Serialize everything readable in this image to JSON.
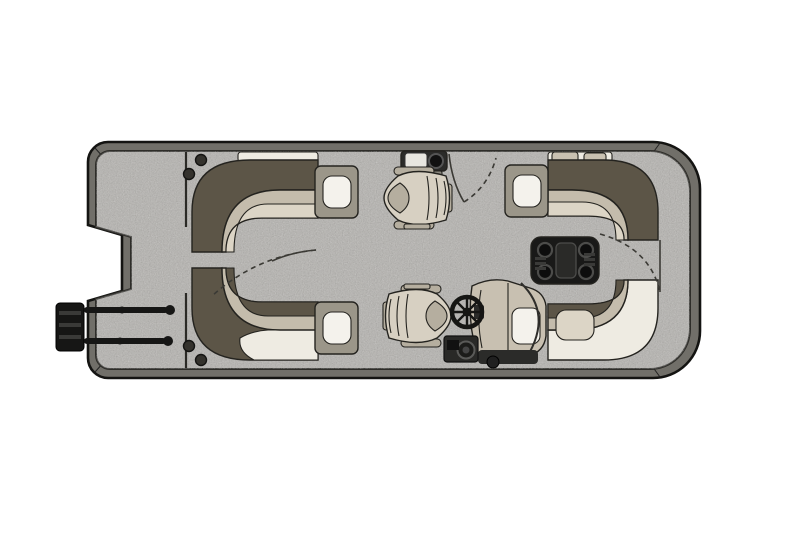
{
  "floorplan": {
    "type": "pontoon-boat-floor-plan",
    "view": "top-down",
    "orientation": "bow-right",
    "components": [
      "stern-swim-deck",
      "motor-cutout-notch",
      "boarding-ladder",
      "port-aft-lounge",
      "starboard-aft-lounge",
      "aft-lounge-armrest-cupholders",
      "stern-gate-swing",
      "port-side-gate-swing",
      "bow-gate-swing",
      "refreshment-console-with-sink",
      "companion-captain-chair",
      "helm-captain-chair",
      "helm-console-with-steering-wheel",
      "cocktail-table-with-cupholders",
      "port-bow-lounge",
      "starboard-bow-lounge",
      "bow-deck",
      "speakers",
      "throw-pillows"
    ]
  },
  "colors": {
    "background": "#ffffff",
    "rim": "#716f69",
    "carpet": "#b4b2ae",
    "panel_line": "#2b2a26",
    "seat_back_dark": "#5c5547",
    "seat_cushion": "#c4bcac",
    "seat_cushion_pale": "#dcd5c6",
    "seat_highlight": "#eeebe2",
    "armrest_panel": "#9b9689",
    "cupholder_white": "#f4f2ec",
    "pillow": "#c9c1b1",
    "table_black": "#191918",
    "table_ring": "#4c4c4a",
    "table_lid": "#2a2a28",
    "chair_body": "#d7d0c2",
    "chair_shade": "#b5ae9f",
    "console_body": "#c8c0b1",
    "console_dark": "#2b2b29",
    "equipment_dark": "#292927",
    "wheel_black": "#161614",
    "speaker_dark": "#34322d",
    "ladder_black": "#161615"
  }
}
